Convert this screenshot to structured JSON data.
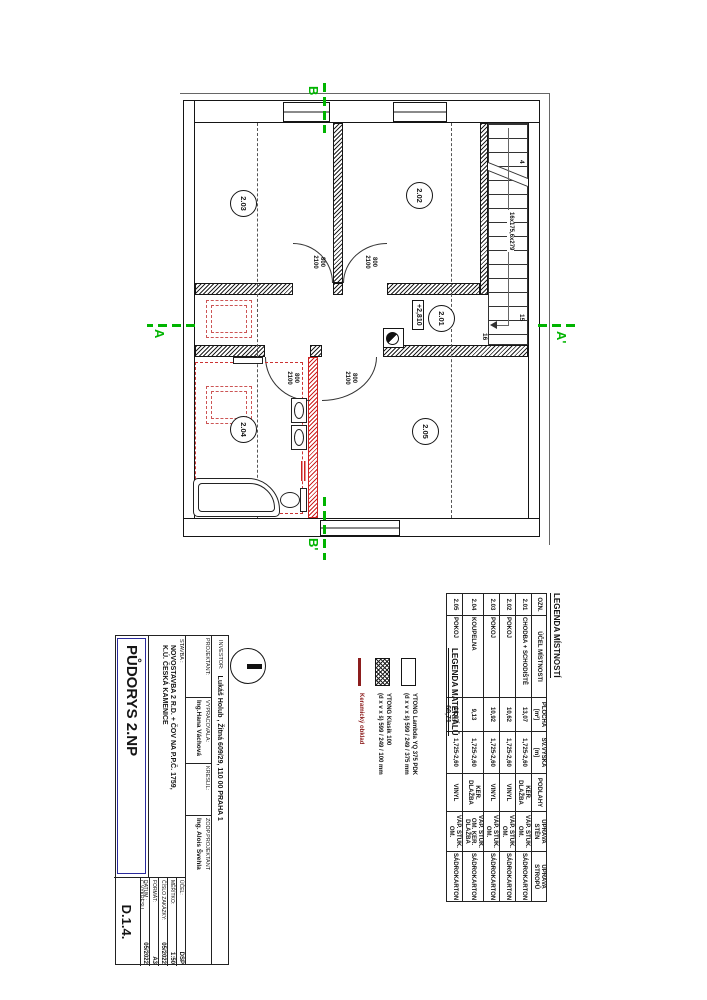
{
  "plan": {
    "room_labels": {
      "r201": "2.01",
      "r202": "2.02",
      "r203": "2.03",
      "r204": "2.04",
      "r205": "2.05"
    },
    "level": "+2,810",
    "stairs": {
      "label": "16x175,6x279",
      "num_top": "4",
      "num_mid": "15",
      "num_bottom": "16"
    },
    "door": {
      "width": "800",
      "height": "2100"
    },
    "sections": {
      "a": "A",
      "a_prime": "A'",
      "b": "B",
      "b_prime": "B'"
    }
  },
  "legend_rooms": {
    "title": "LEGENDA MÍSTNOSTÍ",
    "headers": [
      "OZN.",
      "ÚČEL MÍSTNOSTI",
      "PLOCHA [m²]",
      "SV.VÝŠKA [m]",
      "PODLAHY",
      "ÚPRAVA STĚN",
      "ÚPRAVA STROPŮ"
    ],
    "rows": [
      {
        "ozn": "2.01",
        "ucel": "CHODBA + SCHODIŠTĚ",
        "plocha": "13,07",
        "vyska": "1,725-2,60",
        "podlahy": "KER. DLAŽBA",
        "steny": "VÁP. ŠTUK. OM.",
        "stropy": "SÁDROKARTON"
      },
      {
        "ozn": "2.02",
        "ucel": "POKOJ",
        "plocha": "10,62",
        "vyska": "1,725-2,60",
        "podlahy": "VINYL",
        "steny": "VÁP. ŠTUK. OM.",
        "stropy": "SÁDROKARTON"
      },
      {
        "ozn": "2.03",
        "ucel": "POKOJ",
        "plocha": "10,92",
        "vyska": "1,725-2,60",
        "podlahy": "VINYL",
        "steny": "VÁP. ŠTUK. OM.",
        "stropy": "SÁDROKARTON"
      },
      {
        "ozn": "2.04",
        "ucel": "KOUPELNA",
        "plocha": "9,13",
        "vyska": "1,725-2,60",
        "podlahy": "KER. DLAŽBA",
        "steny": "VÁP. ŠTUK. OM. KER. DLAŽBA",
        "stropy": "SÁDROKARTON"
      },
      {
        "ozn": "2.05",
        "ucel": "POKOJ",
        "plocha": "16,97",
        "vyska": "1,725-2,60",
        "podlahy": "VINYL",
        "steny": "VÁP. ŠTUK. OM.",
        "stropy": "SÁDROKARTON"
      }
    ],
    "total_area": "60,71"
  },
  "legend_materials": {
    "title": "LEGENDA MATERIÁLŮ",
    "items": [
      {
        "name": "YTONG Lambda YQ 375 PDK",
        "dims": "(d x v x š) 599 / 249 / 375 mm"
      },
      {
        "name": "YTONG Klasik 100",
        "dims": "(d x v x š) 599 / 249 / 100 mm"
      },
      {
        "name": "Keramický obklad",
        "dims": ""
      }
    ]
  },
  "title_block": {
    "investor_label": "INVESTOR:",
    "investor_value": "Lukáš Holub , Žitná 609/29, 110 00 PRAHA 1",
    "projektant_label": "PROJEKTANT:",
    "vypracovala_label": "VYPRACOVALA:",
    "vypracovala_value": "Ing.Hana Váchová",
    "kreslil_label": "KRESLIL:",
    "zodp_label": "ZODP.PROJEKTANT",
    "zodp_value": "Ing. Alois Švehla",
    "stavba_label": "STAVBA :",
    "stavba_line1": "NOVOSTAVBA 2 R.D. + ČOV NA P.P.Č. 1759,",
    "stavba_line2": "K.Ú. ČESKÁ KAMENICE",
    "drawing_title": "PŮDORYS 2.NP",
    "ucel_label": "ÚČEL:",
    "ucel_value": "DSP",
    "meritko_label": "MĚŘÍTKO:",
    "meritko_value": "1:50",
    "zakazka_label": "ČÍSLO ZAKÁZKY:",
    "zakazka_value": "05/2022",
    "format_label": "FORMÁT:",
    "format_value": "A3",
    "datum_label": "DATUM :",
    "datum_value": "05/2022",
    "vykres_label": "Č.VÝKRESU",
    "vykres_value": "D.1.4."
  }
}
